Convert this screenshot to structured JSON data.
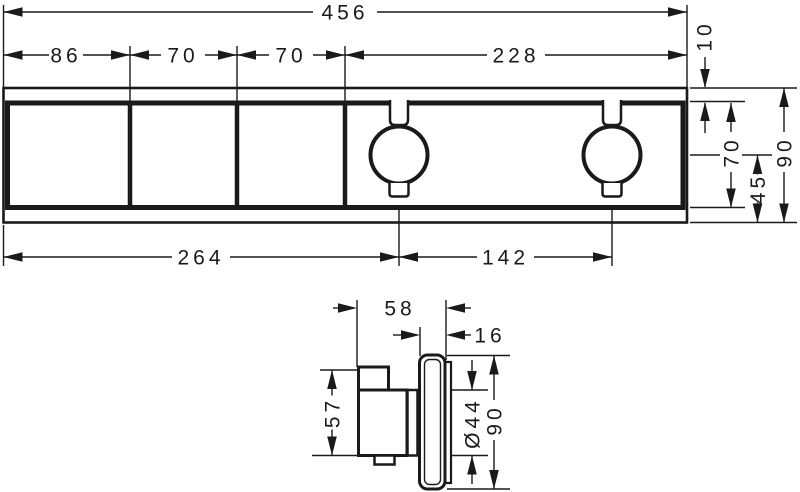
{
  "colors": {
    "ink": "#1a1a1a",
    "background": "#ffffff"
  },
  "front_view": {
    "overall_width": "456",
    "segment_left": "86",
    "segment_mid_1": "70",
    "segment_mid_2": "70",
    "segment_right": "228",
    "top_strip": "10",
    "frame_height": "70",
    "overall_height": "90",
    "handle_axis_from_bottom": "45",
    "left_edge_to_handle": "264",
    "handle_spacing": "142"
  },
  "side_view": {
    "depth": "58",
    "escutcheon_thickness": "16",
    "handle_height": "57",
    "handle_diameter": "Ø44",
    "escutcheon_height": "90"
  }
}
